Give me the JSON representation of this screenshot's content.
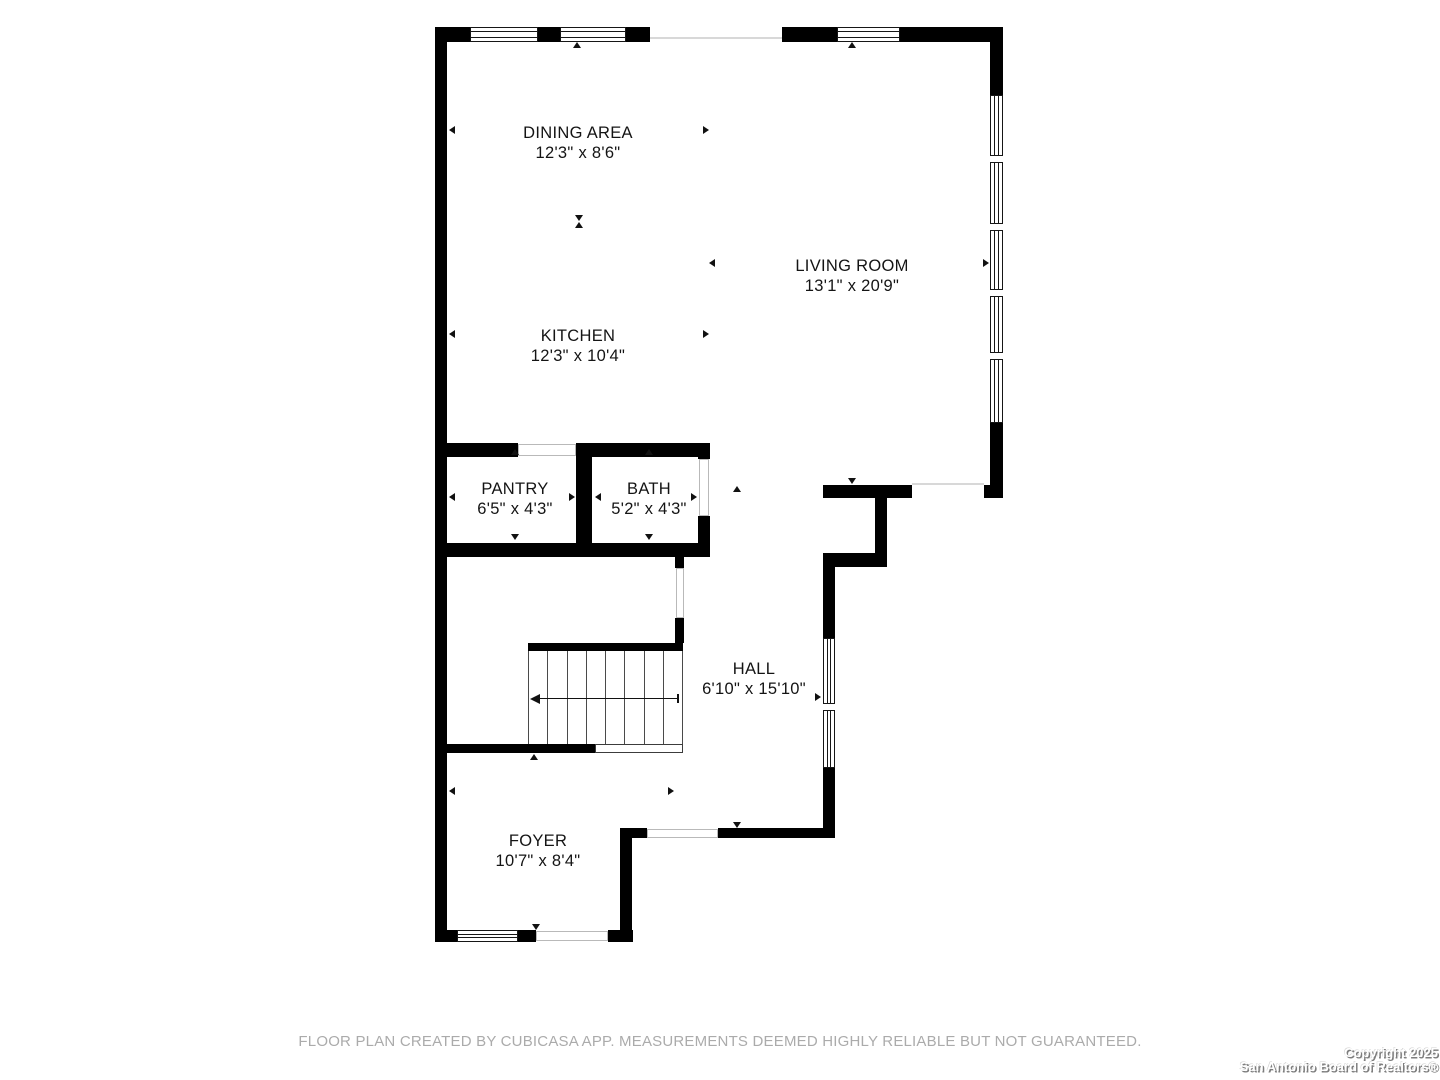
{
  "floorplan": {
    "colors": {
      "wall": "#000000",
      "opening_line": "#d8d8d8",
      "stair_line": "#4a4a4a",
      "label": "#141414"
    },
    "rooms": [
      {
        "id": "dining",
        "name": "DINING AREA",
        "dims": "12'3\" x 8'6\"",
        "cx": 578,
        "cy": 143
      },
      {
        "id": "living",
        "name": "LIVING ROOM",
        "dims": "13'1\" x 20'9\"",
        "cx": 852,
        "cy": 276
      },
      {
        "id": "kitchen",
        "name": "KITCHEN",
        "dims": "12'3\" x 10'4\"",
        "cx": 578,
        "cy": 346
      },
      {
        "id": "pantry",
        "name": "PANTRY",
        "dims": "6'5\" x 4'3\"",
        "cx": 515,
        "cy": 499
      },
      {
        "id": "bath",
        "name": "BATH",
        "dims": "5'2\" x 4'3\"",
        "cx": 649,
        "cy": 499
      },
      {
        "id": "hall",
        "name": "HALL",
        "dims": "6'10\" x 15'10\"",
        "cx": 754,
        "cy": 679
      },
      {
        "id": "foyer",
        "name": "FOYER",
        "dims": "10'7\" x 8'4\"",
        "cx": 538,
        "cy": 851
      }
    ],
    "walls": [
      {
        "name": "wall-left-exterior",
        "x": 435,
        "y": 27,
        "w": 12,
        "h": 915
      },
      {
        "name": "wall-top-left",
        "x": 435,
        "y": 27,
        "w": 215,
        "h": 15
      },
      {
        "name": "wall-top-right",
        "x": 782,
        "y": 27,
        "w": 221,
        "h": 15
      },
      {
        "name": "wall-right-upper",
        "x": 990,
        "y": 27,
        "w": 13,
        "h": 68
      },
      {
        "name": "wall-right-lower",
        "x": 990,
        "y": 423,
        "w": 13,
        "h": 75
      },
      {
        "name": "wall-right-foot",
        "x": 984,
        "y": 485,
        "w": 6,
        "h": 13
      },
      {
        "name": "wall-hall-top",
        "x": 823,
        "y": 485,
        "w": 89,
        "h": 13
      },
      {
        "name": "wall-closet-right",
        "x": 875,
        "y": 498,
        "w": 12,
        "h": 55
      },
      {
        "name": "wall-closet-bottom",
        "x": 823,
        "y": 553,
        "w": 64,
        "h": 14
      },
      {
        "name": "wall-hall-right-upper",
        "x": 823,
        "y": 567,
        "w": 12,
        "h": 71
      },
      {
        "name": "wall-hall-right-lower",
        "x": 823,
        "y": 768,
        "w": 12,
        "h": 70
      },
      {
        "name": "wall-hall-bottom",
        "x": 718,
        "y": 828,
        "w": 117,
        "h": 10
      },
      {
        "name": "wall-foyer-top-stub",
        "x": 620,
        "y": 828,
        "w": 27,
        "h": 10
      },
      {
        "name": "wall-foyer-right",
        "x": 620,
        "y": 838,
        "w": 12,
        "h": 104
      },
      {
        "name": "wall-bottom-left",
        "x": 435,
        "y": 930,
        "w": 22,
        "h": 12
      },
      {
        "name": "wall-bottom-mid",
        "x": 518,
        "y": 930,
        "w": 18,
        "h": 12
      },
      {
        "name": "wall-bottom-right",
        "x": 608,
        "y": 930,
        "w": 25,
        "h": 12
      },
      {
        "name": "wall-pantry-top",
        "x": 447,
        "y": 443,
        "w": 71,
        "h": 14
      },
      {
        "name": "wall-bath-top",
        "x": 576,
        "y": 443,
        "w": 134,
        "h": 14
      },
      {
        "name": "wall-pantry-bath-divider",
        "x": 576,
        "y": 443,
        "w": 16,
        "h": 114
      },
      {
        "name": "wall-bath-right-upper",
        "x": 698,
        "y": 443,
        "w": 12,
        "h": 16
      },
      {
        "name": "wall-bath-right-lower",
        "x": 698,
        "y": 516,
        "w": 12,
        "h": 29
      },
      {
        "name": "wall-pantry-bath-bottom",
        "x": 447,
        "y": 543,
        "w": 263,
        "h": 14
      },
      {
        "name": "wall-under-bath-stub",
        "x": 675,
        "y": 557,
        "w": 9,
        "h": 11
      },
      {
        "name": "wall-stairs-right-upper",
        "x": 675,
        "y": 618,
        "w": 9,
        "h": 25
      },
      {
        "name": "wall-stairs-top",
        "x": 528,
        "y": 643,
        "w": 155,
        "h": 8
      },
      {
        "name": "wall-stairs-bottom",
        "x": 447,
        "y": 744,
        "w": 148,
        "h": 9
      }
    ],
    "windows": [
      {
        "name": "window-dining-1",
        "x": 470,
        "y": 27,
        "w": 68,
        "h": 15,
        "orient": "h",
        "mullions": []
      },
      {
        "name": "window-dining-2",
        "x": 560,
        "y": 27,
        "w": 66,
        "h": 15,
        "orient": "h",
        "mullions": []
      },
      {
        "name": "window-living-top",
        "x": 837,
        "y": 27,
        "w": 63,
        "h": 15,
        "orient": "h",
        "mullions": []
      },
      {
        "name": "window-living-right",
        "x": 990,
        "y": 95,
        "w": 13,
        "h": 328,
        "orient": "v",
        "mullions": [
          59,
          127,
          193,
          256
        ]
      },
      {
        "name": "window-hall",
        "x": 823,
        "y": 638,
        "w": 12,
        "h": 130,
        "orient": "v",
        "mullions": [
          64
        ]
      },
      {
        "name": "window-foyer",
        "x": 457,
        "y": 930,
        "w": 61,
        "h": 12,
        "orient": "h",
        "mullions": []
      }
    ],
    "opening_lines": [
      {
        "name": "opening-dining-top",
        "x": 650,
        "y": 37,
        "w": 132,
        "h": 2
      },
      {
        "name": "opening-living-hall",
        "x": 912,
        "y": 483,
        "w": 72,
        "h": 2
      }
    ],
    "opening_jambs": [
      {
        "name": "opening-pantry-door",
        "x": 518,
        "y": 444,
        "w": 58,
        "h": 12
      },
      {
        "name": "opening-bath-door",
        "x": 699,
        "y": 459,
        "w": 10,
        "h": 57
      },
      {
        "name": "opening-under-stairs-door",
        "x": 676,
        "y": 568,
        "w": 8,
        "h": 50
      },
      {
        "name": "opening-hall-foyer",
        "x": 647,
        "y": 829,
        "w": 71,
        "h": 9
      },
      {
        "name": "opening-front-door",
        "x": 536,
        "y": 931,
        "w": 72,
        "h": 10
      }
    ],
    "stairs": {
      "x": 528,
      "y": 651,
      "w": 154,
      "h": 93,
      "treads": 8,
      "arrow_y": 698,
      "arrow_x1": 530,
      "arrow_x2": 678,
      "landing": {
        "x": 595,
        "y": 744,
        "w": 88,
        "h": 9
      }
    },
    "markers": [
      {
        "x": 452,
        "y": 130,
        "dir": "left"
      },
      {
        "x": 706,
        "y": 130,
        "dir": "right"
      },
      {
        "x": 577,
        "y": 45,
        "dir": "up"
      },
      {
        "x": 852,
        "y": 45,
        "dir": "up"
      },
      {
        "x": 579,
        "y": 218,
        "dir": "down"
      },
      {
        "x": 579,
        "y": 225,
        "dir": "up"
      },
      {
        "x": 712,
        "y": 263,
        "dir": "left"
      },
      {
        "x": 986,
        "y": 263,
        "dir": "right"
      },
      {
        "x": 452,
        "y": 334,
        "dir": "left"
      },
      {
        "x": 706,
        "y": 334,
        "dir": "right"
      },
      {
        "x": 515,
        "y": 452,
        "dir": "up"
      },
      {
        "x": 515,
        "y": 537,
        "dir": "down"
      },
      {
        "x": 452,
        "y": 497,
        "dir": "left"
      },
      {
        "x": 572,
        "y": 497,
        "dir": "right"
      },
      {
        "x": 649,
        "y": 452,
        "dir": "up"
      },
      {
        "x": 649,
        "y": 537,
        "dir": "down"
      },
      {
        "x": 598,
        "y": 497,
        "dir": "left"
      },
      {
        "x": 694,
        "y": 497,
        "dir": "right"
      },
      {
        "x": 852,
        "y": 481,
        "dir": "down"
      },
      {
        "x": 737,
        "y": 489,
        "dir": "up"
      },
      {
        "x": 818,
        "y": 697,
        "dir": "right"
      },
      {
        "x": 737,
        "y": 825,
        "dir": "down"
      },
      {
        "x": 534,
        "y": 757,
        "dir": "up"
      },
      {
        "x": 452,
        "y": 791,
        "dir": "left"
      },
      {
        "x": 671,
        "y": 791,
        "dir": "right"
      },
      {
        "x": 536,
        "y": 927,
        "dir": "down"
      }
    ]
  },
  "footer": {
    "disclaimer": "FLOOR PLAN CREATED BY CUBICASA APP. MEASUREMENTS DEEMED HIGHLY RELIABLE BUT NOT GUARANTEED."
  },
  "copyright": {
    "line1": "Copyright 2025",
    "line2": "San Antonio Board of Realtors®"
  }
}
